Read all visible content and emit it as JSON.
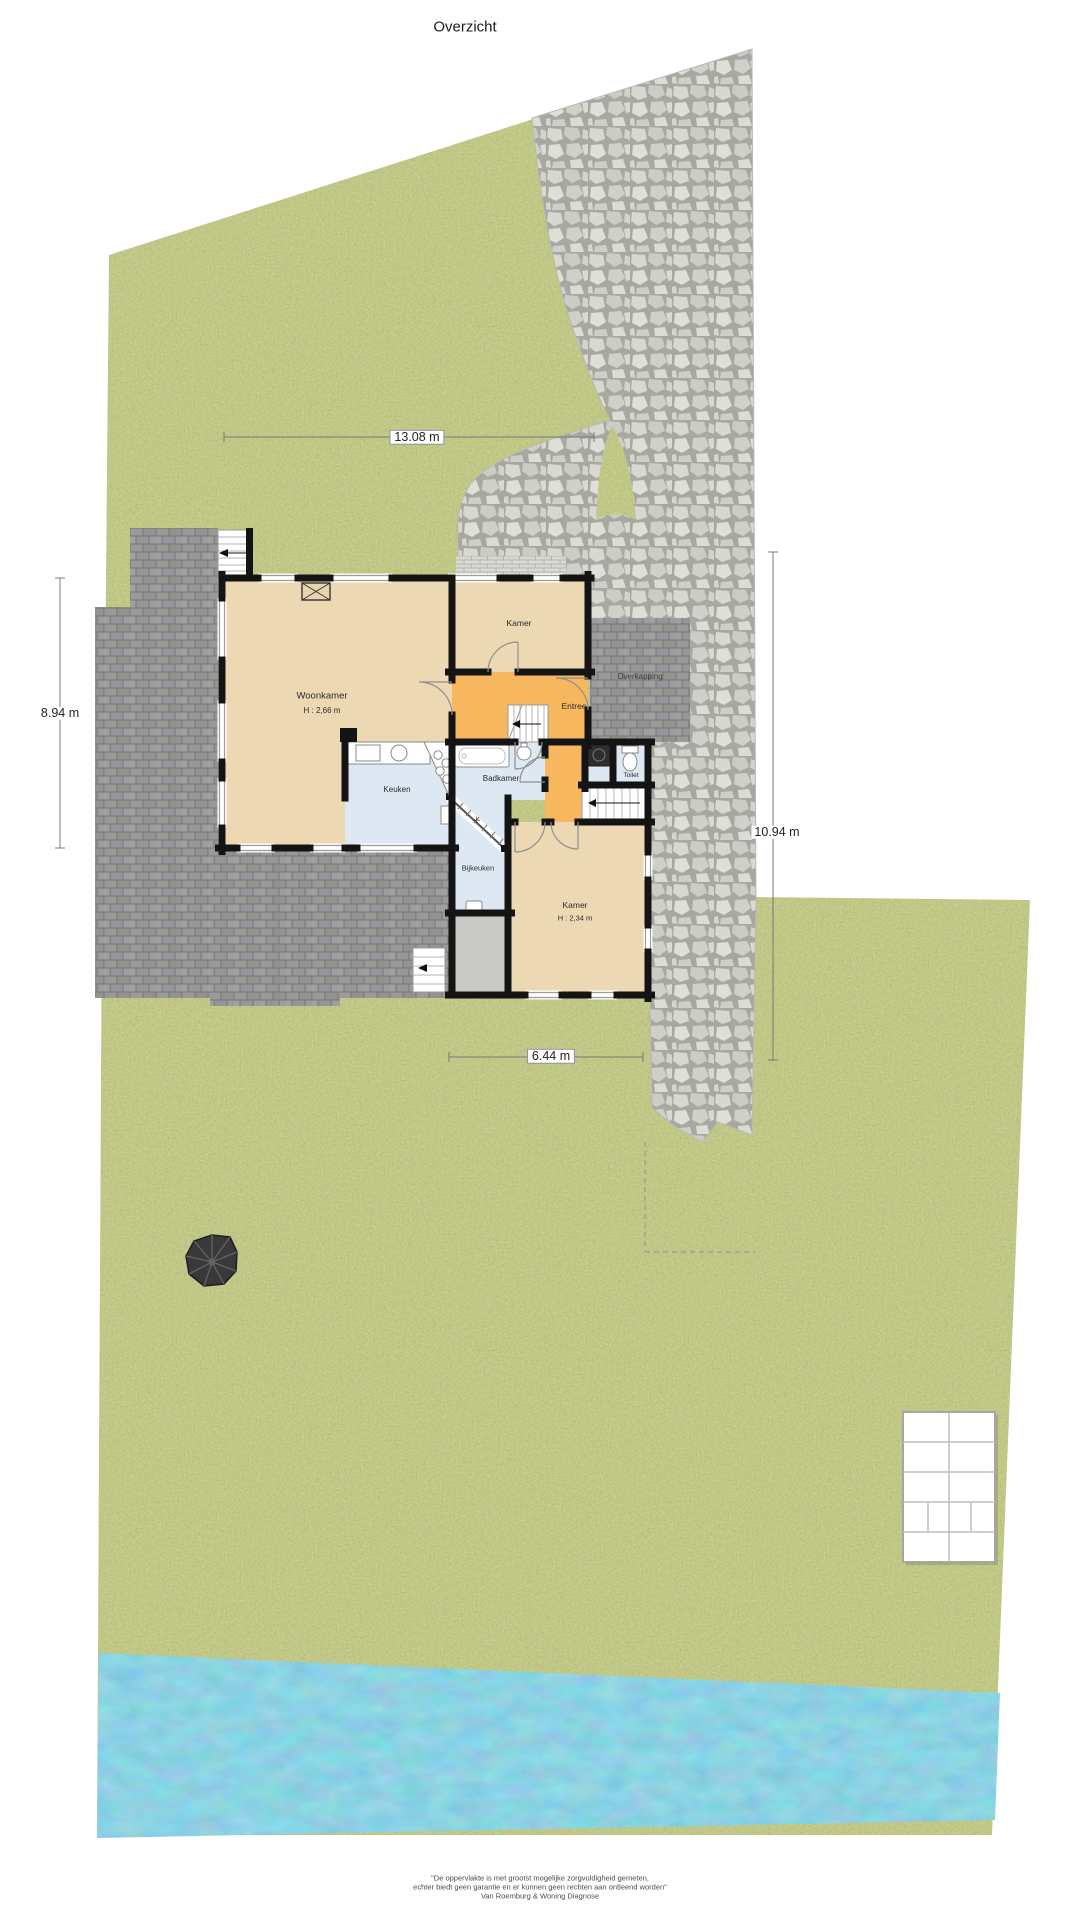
{
  "title": "Overzicht",
  "dimensions": {
    "top": "13.08 m",
    "left": "8.94 m",
    "right": "10.94 m",
    "bottom": "6.44 m"
  },
  "rooms": {
    "woonkamer": {
      "label": "Woonkamer",
      "height": "H : 2,66 m"
    },
    "kamer_boven": {
      "label": "Kamer"
    },
    "entree": {
      "label": "Entree"
    },
    "overkapping": {
      "label": "Overkapping"
    },
    "keuken": {
      "label": "Keuken"
    },
    "badkamer": {
      "label": "Badkamer"
    },
    "toilet": {
      "label": "Toilet"
    },
    "bijkeuken": {
      "label": "Bijkeuken"
    },
    "kast": {
      "label": "K"
    },
    "kamer_achter": {
      "label": "Kamer",
      "height": "H : 2,34 m"
    }
  },
  "footer": {
    "line1": "\"De oppervlakte is met grootst mogelijke zorgvuldigheid gemeten,",
    "line2": "echter biedt geen garantie en er kunnen geen rechten aan ontleend worden\"",
    "line3": "Van Roemburg & Woning Diagnose"
  },
  "colors": {
    "grass": "#87913d",
    "stone": "#cfcfc9",
    "dark_paving": "#8f8f8d",
    "water": "#41a6c7",
    "floor_beige": "#ecd9b4",
    "floor_orange": "#f6b75f",
    "floor_blue": "#dde8f2",
    "floor_gray": "#c9c9c6",
    "wall": "#141414"
  }
}
